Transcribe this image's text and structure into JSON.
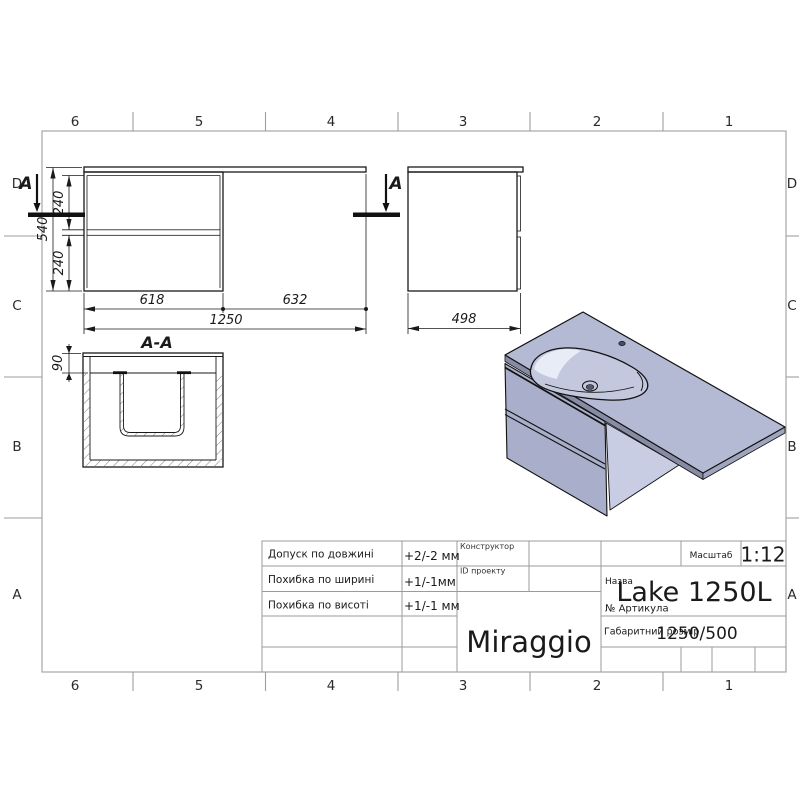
{
  "sheet": {
    "grid_columns": [
      "6",
      "5",
      "4",
      "3",
      "2",
      "1"
    ],
    "grid_rows": [
      "D",
      "C",
      "B",
      "A"
    ]
  },
  "views": {
    "front": {
      "section_label": "A",
      "w_left": "618",
      "w_right": "632",
      "w_total": "1250",
      "height": "540",
      "drawer_top": "240",
      "drawer_bottom": "240"
    },
    "side": {
      "depth": "498"
    },
    "section": {
      "title": "A-A",
      "countertop_thickness": "90"
    }
  },
  "render3d": {
    "colors": {
      "top_face": "#b5bad4",
      "front_face": "#a9aeca",
      "side_face": "#c9cde3",
      "front_edge": "#878ca6",
      "right_edge": "#a0a5bf",
      "basin": "#c3c8de",
      "highlight": "#e8ecf6",
      "drain_dark": "#55596e",
      "faucet_dark": "#494d63"
    }
  },
  "title_block": {
    "tolerances": [
      {
        "label": "Допуск по довжині",
        "value": "+2/-2 мм"
      },
      {
        "label": "Похибка по ширині",
        "value": "+1/-1мм"
      },
      {
        "label": "Похибка по висоті",
        "value": "+1/-1 мм"
      }
    ],
    "constructor_label": "Конструктор",
    "project_id_label": "ID проекту",
    "scale_label": "Масштаб",
    "scale_value": "1:12",
    "name_label": "Назва",
    "name_value": "Lake 1250L",
    "article_label": "№  Артикула",
    "overall_label": "Габаритний розмір",
    "overall_value": "1250/500",
    "brand": "Miraggio"
  }
}
